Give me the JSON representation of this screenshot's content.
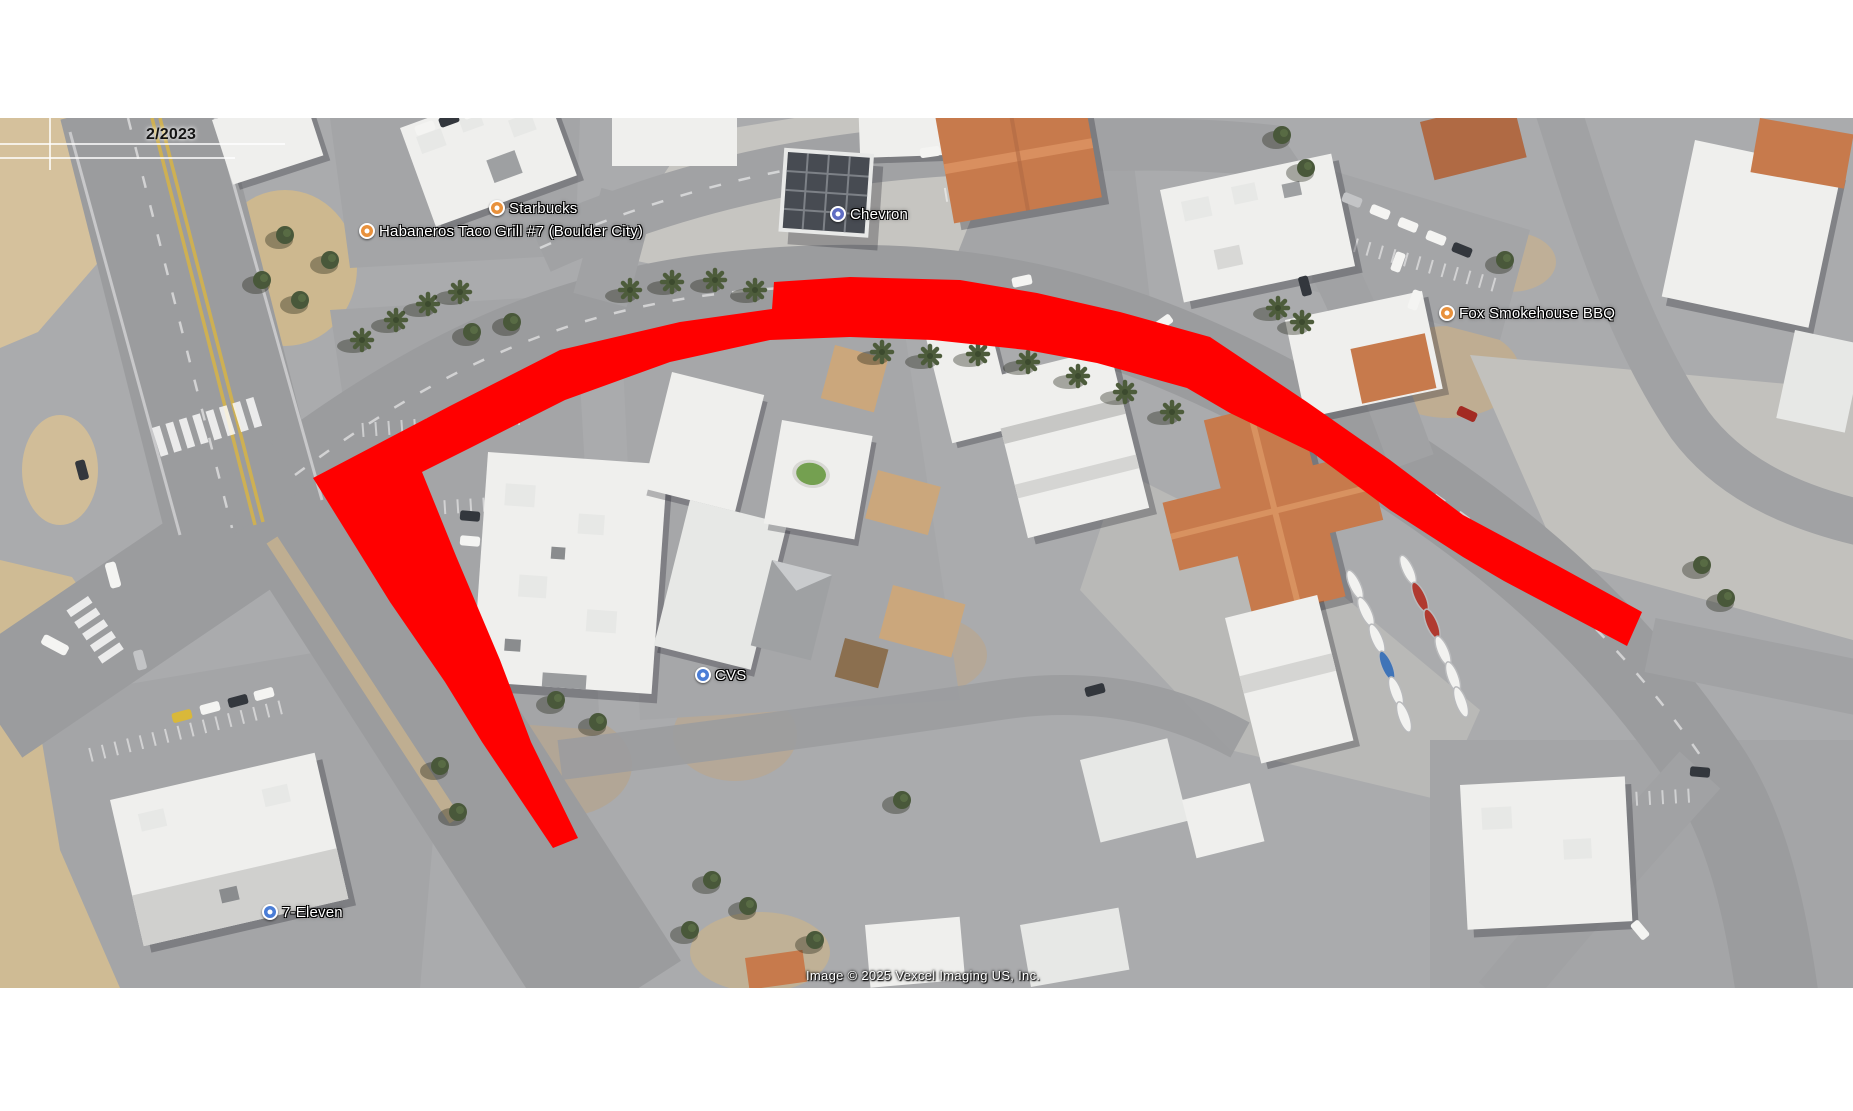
{
  "map": {
    "timestamp_label": "2/2023",
    "attribution": "Image © 2025 Vexcel Imaging US, Inc.",
    "route_highlight": {
      "color": "#ff0000",
      "points": [
        [
          553,
          848
        ],
        [
          482,
          742
        ],
        [
          445,
          682
        ],
        [
          390,
          602
        ],
        [
          313,
          478
        ],
        [
          450,
          406
        ],
        [
          560,
          350
        ],
        [
          680,
          322
        ],
        [
          772,
          309
        ],
        [
          774,
          282
        ],
        [
          850,
          277
        ],
        [
          960,
          280
        ],
        [
          1037,
          293
        ],
        [
          1120,
          312
        ],
        [
          1210,
          337
        ],
        [
          1307,
          402
        ],
        [
          1390,
          460
        ],
        [
          1463,
          515
        ],
        [
          1560,
          567
        ],
        [
          1642,
          612
        ],
        [
          1627,
          646
        ],
        [
          1504,
          581
        ],
        [
          1463,
          557
        ],
        [
          1390,
          510
        ],
        [
          1313,
          453
        ],
        [
          1230,
          413
        ],
        [
          1187,
          388
        ],
        [
          1097,
          363
        ],
        [
          1027,
          350
        ],
        [
          933,
          340
        ],
        [
          850,
          337
        ],
        [
          770,
          340
        ],
        [
          670,
          362
        ],
        [
          565,
          400
        ],
        [
          470,
          448
        ],
        [
          422,
          472
        ],
        [
          456,
          556
        ],
        [
          500,
          660
        ],
        [
          531,
          742
        ],
        [
          578,
          838
        ]
      ]
    },
    "labels": [
      {
        "id": "starbucks",
        "name": "Starbucks",
        "icon": "cafe",
        "icon_color": "#e8913c",
        "x": 497,
        "y": 208
      },
      {
        "id": "habaneros-taco-grill",
        "name": "Habaneros Taco Grill #7 (Boulder City)",
        "icon": "restaurant",
        "icon_color": "#e8913c",
        "x": 367,
        "y": 231
      },
      {
        "id": "chevron",
        "name": "Chevron",
        "icon": "gas-station",
        "icon_color": "#5f6dc3",
        "x": 838,
        "y": 214
      },
      {
        "id": "fox-smokehouse-bbq",
        "name": "Fox Smokehouse BBQ",
        "icon": "restaurant",
        "icon_color": "#e8913c",
        "x": 1447,
        "y": 313
      },
      {
        "id": "cvs",
        "name": "CVS",
        "icon": "pharmacy",
        "icon_color": "#4a7dd6",
        "x": 703,
        "y": 675
      },
      {
        "id": "seven-eleven",
        "name": "7-Eleven",
        "icon": "convenience-store",
        "icon_color": "#4a7dd6",
        "x": 270,
        "y": 912
      }
    ]
  }
}
